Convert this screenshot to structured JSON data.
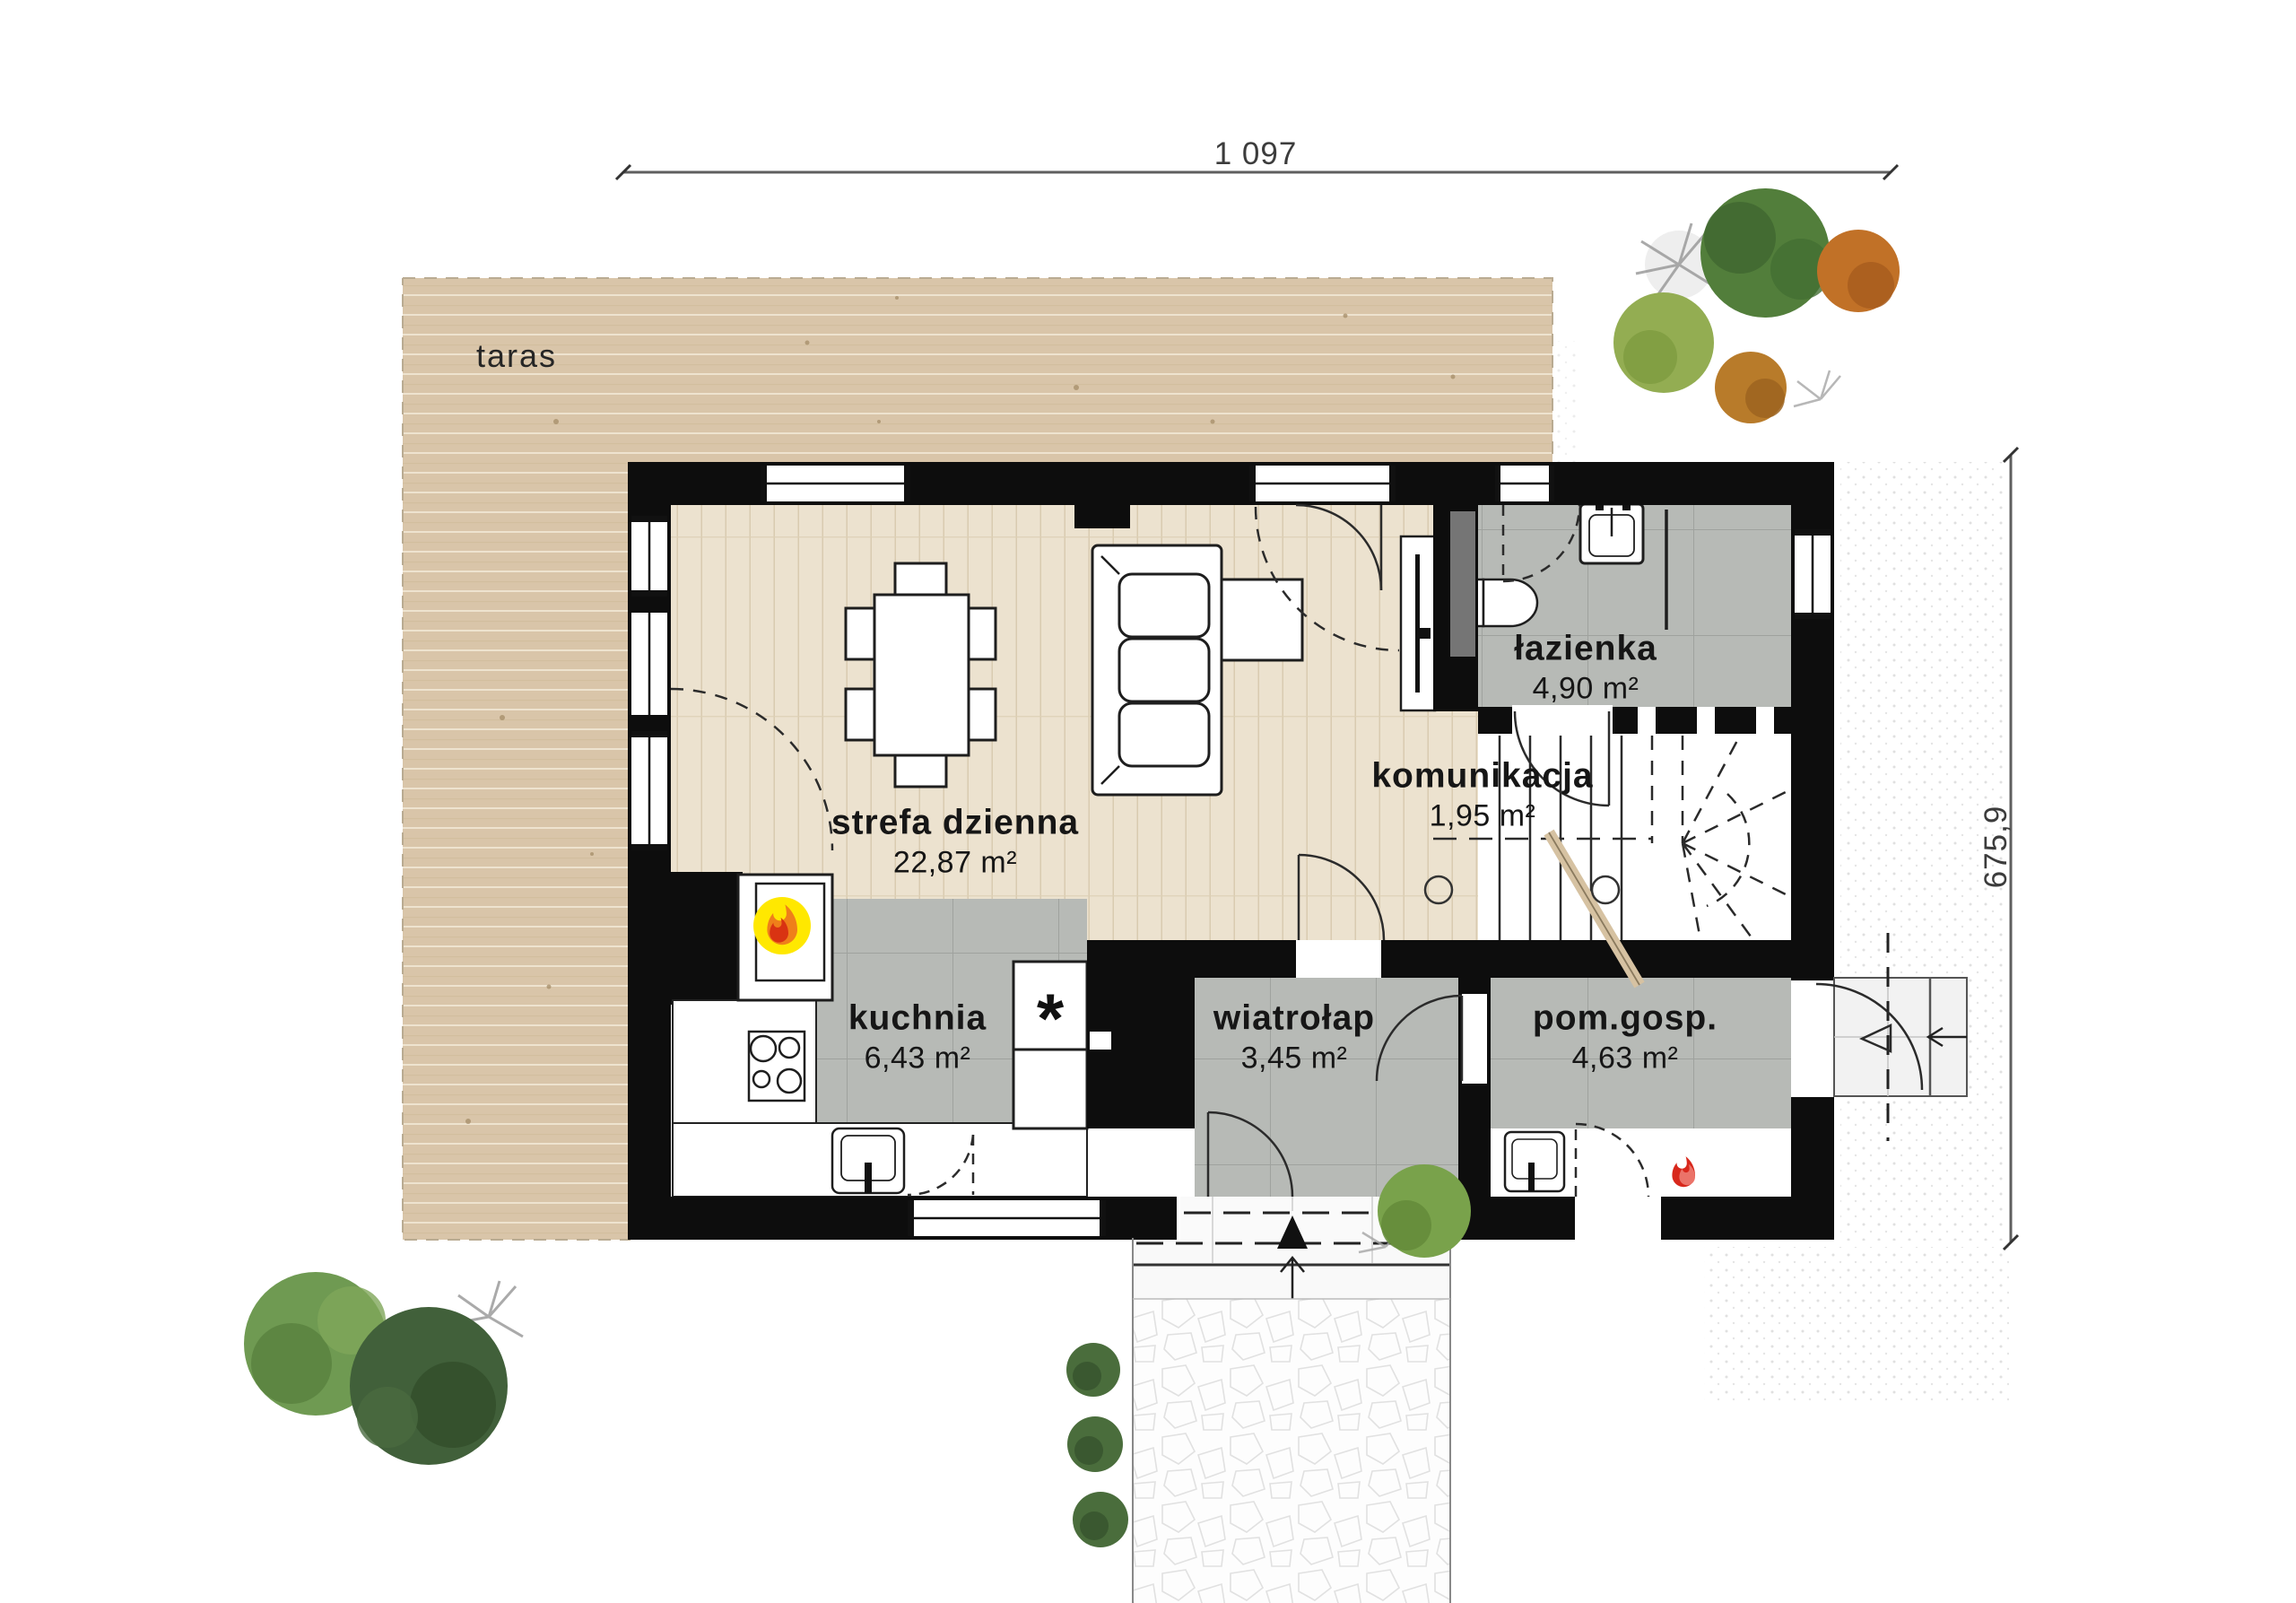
{
  "dimensions": {
    "top": "1 097",
    "right": "675,9"
  },
  "rooms": {
    "taras": {
      "name": "taras",
      "area": ""
    },
    "strefa_dzienna": {
      "name": "strefa dzienna",
      "area": "22,87 m²"
    },
    "lazienka": {
      "name": "łazienka",
      "area": "4,90 m²"
    },
    "komunikacja": {
      "name": "komunikacja",
      "area": "1,95 m²"
    },
    "kuchnia": {
      "name": "kuchnia",
      "area": "6,43 m²"
    },
    "wiatrolap": {
      "name": "wiatrołap",
      "area": "3,45 m²"
    },
    "pom_gosp": {
      "name": "pom.gosp.",
      "area": "4,63 m²"
    }
  },
  "symbols": {
    "fridge_star": "*"
  },
  "icons": {
    "fireplace": "flame-icon-yellow",
    "boiler": "flame-icon-red"
  },
  "colors": {
    "wall": "#0d0d0d",
    "terrace_wood": "#d9c5a9",
    "parquet": "#ece2cf",
    "tile": "#b7bab6",
    "tile_line": "#9fa29e",
    "fireplace_yellow": "#ffe800",
    "flame_orange": "#ef7f1a",
    "flame_red": "#d62b12",
    "tree_green": "#527e3b",
    "tree_orange": "#c17127"
  }
}
